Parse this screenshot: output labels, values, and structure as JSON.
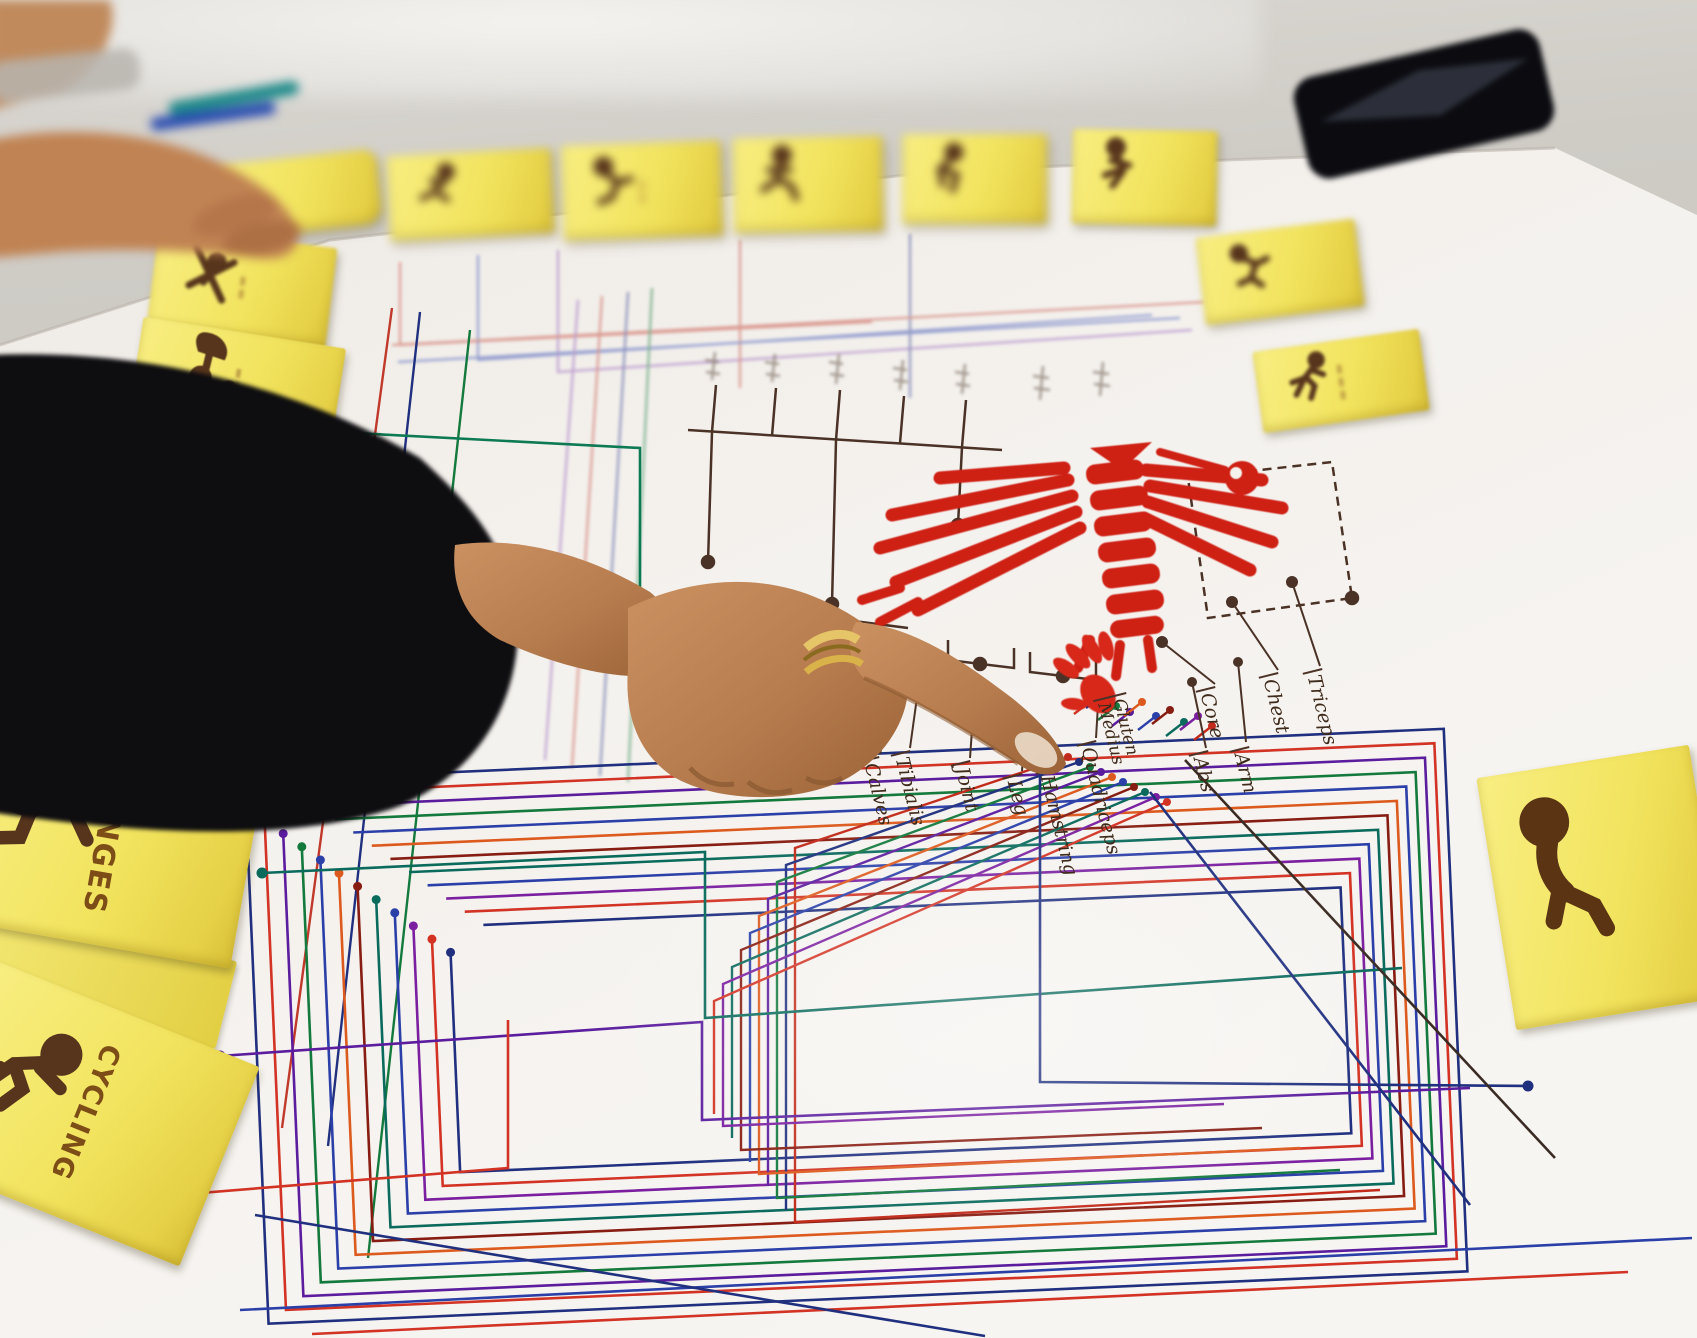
{
  "scene_type": "photo of a hand pointing at a hand-drawn exercise/muscle mapping poster with yellow sticky notes",
  "notes": {
    "lunges": "LUNGES",
    "cycling": "CYCLING"
  },
  "labels": {
    "core": "Core",
    "chest": "Chest",
    "triceps": "Triceps",
    "glutes": "Gluten Medius",
    "quadriceps": "Quadriceps",
    "abs": "Abs",
    "arm": "Arm",
    "calves": "Calves",
    "tibialis": "Tibialis",
    "joint": "Joint",
    "leg": "Leg",
    "hamstring": "Hamstring"
  },
  "icons": [
    "leg-press-exercise-icon",
    "cyclist-icon",
    "deadlift-figure-icon",
    "ski-fall-figure-icon",
    "parachute-sprint-figure-icon",
    "sprinter-figure-icon",
    "exercise-figure-icon",
    "red-handprint-icon",
    "muscle-anatomy-figure-icon"
  ],
  "colors": {
    "sticky_yellow": "#f2e45f",
    "marker_red": "#cf2014",
    "marker_brown": "#4a3226",
    "icon_brown": "#57351c",
    "line_navy": "#20307f",
    "line_red": "#d23324",
    "line_green": "#14793c",
    "line_purple": "#5b1d9e",
    "line_orange": "#dd5a1e",
    "line_teal": "#0a6a5c",
    "paper_white": "#f5f2ee",
    "table_gray": "#c9c5bf",
    "sleeve_black": "#0e0d10",
    "skin_tan": "#bb8155",
    "ring_gold": "#d9b24a"
  }
}
